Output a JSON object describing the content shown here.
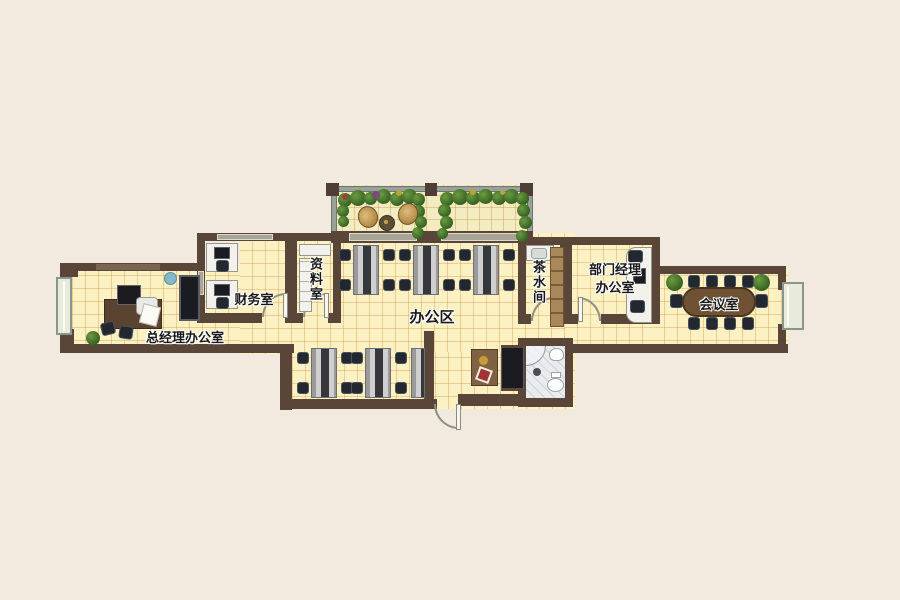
{
  "rooms": {
    "general_manager_office": {
      "label": "总经理办公室"
    },
    "finance_room": {
      "label": "财务室"
    },
    "archive_room": {
      "label": "资料室"
    },
    "office_area": {
      "label": "办公区"
    },
    "tea_room": {
      "label": "茶水间"
    },
    "department_manager_office": {
      "label_lines": [
        "部门经理",
        "办公室"
      ]
    },
    "meeting_room": {
      "label": "会议室"
    }
  },
  "colors": {
    "wall": "#594639",
    "floor": "#fcf1c3",
    "floor_grid": "#d6923c",
    "background": "#f2e9df",
    "meeting_table": "#6f5133",
    "window_fill": "#e8eada",
    "plant_green": "#3d6b26"
  }
}
